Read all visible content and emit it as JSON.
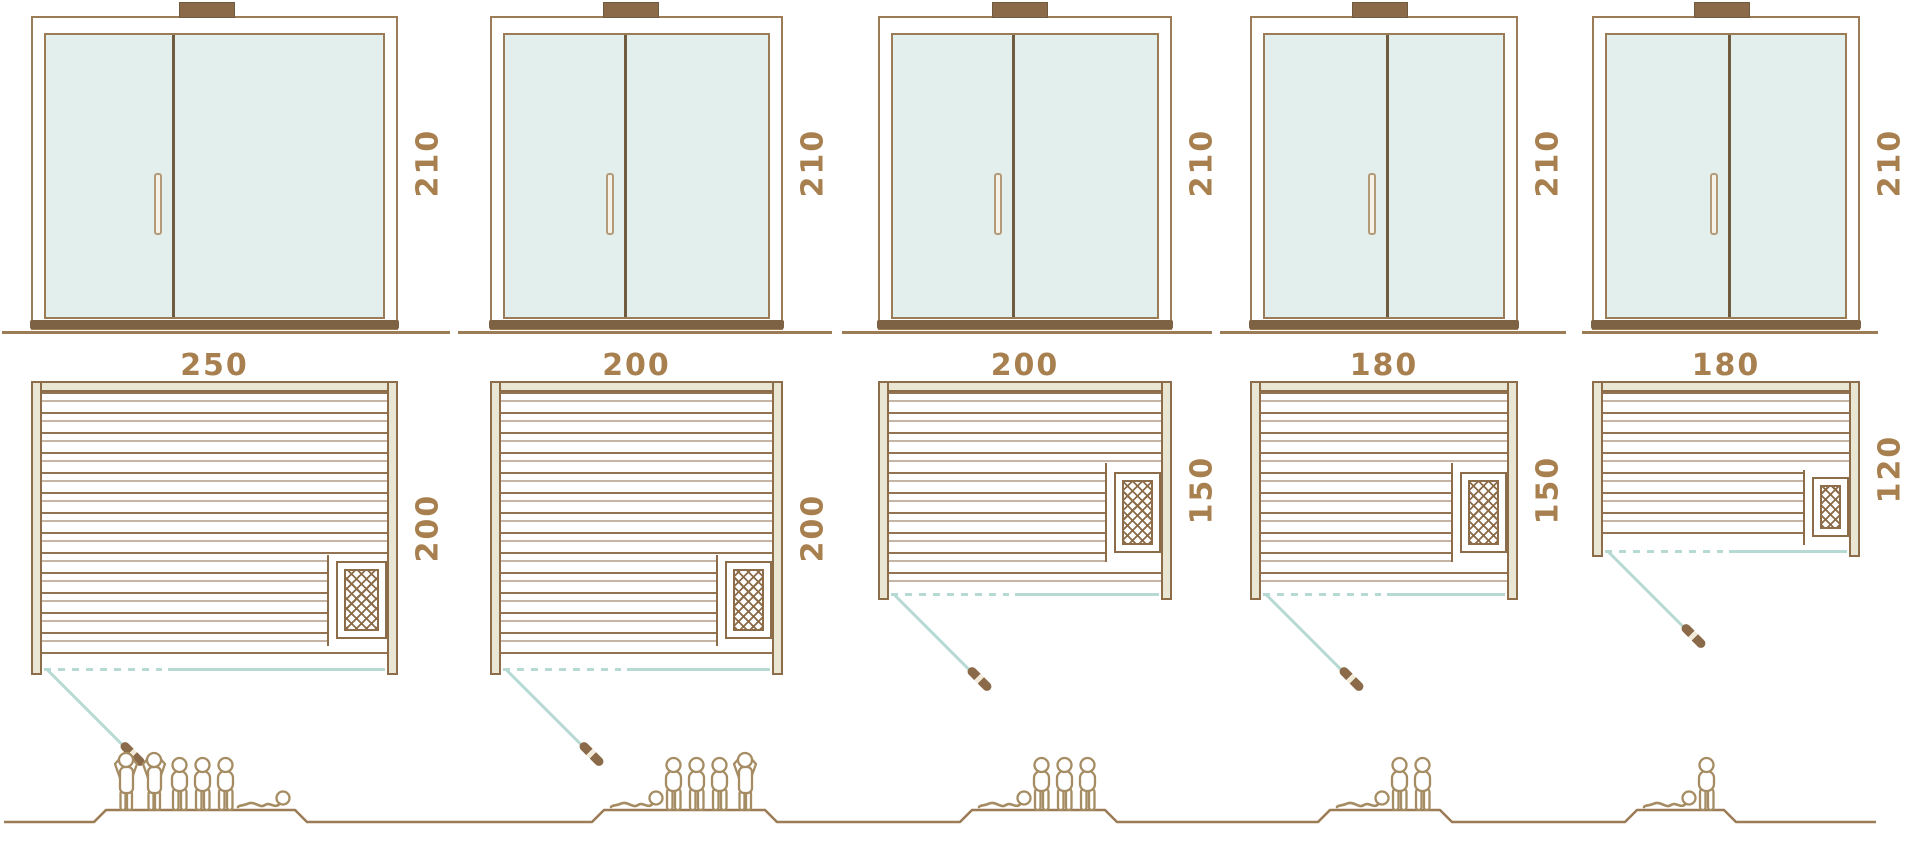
{
  "units": [
    {
      "id": "sauna-1",
      "height_label": "210",
      "width_label": "250",
      "depth_label": "200",
      "capacity": 6,
      "figures": [
        "standing",
        "standing",
        "sitting",
        "sitting",
        "sitting",
        "lying"
      ]
    },
    {
      "id": "sauna-2",
      "height_label": "210",
      "width_label": "200",
      "depth_label": "200",
      "capacity": 5,
      "figures": [
        "lying",
        "sitting",
        "sitting",
        "sitting",
        "standing"
      ]
    },
    {
      "id": "sauna-3",
      "height_label": "210",
      "width_label": "200",
      "depth_label": "150",
      "capacity": 4,
      "figures": [
        "lying",
        "sitting",
        "sitting",
        "sitting"
      ]
    },
    {
      "id": "sauna-4",
      "height_label": "210",
      "width_label": "180",
      "depth_label": "150",
      "capacity": 3,
      "figures": [
        "lying",
        "sitting",
        "sitting"
      ]
    },
    {
      "id": "sauna-5",
      "height_label": "210",
      "width_label": "180",
      "depth_label": "120",
      "capacity": 2,
      "figures": [
        "lying",
        "sitting"
      ]
    }
  ],
  "colors": {
    "line_brown": "#8d6c49",
    "frame_brown": "#9b7c56",
    "dark_brown": "#6f5c40",
    "sill_brown": "#7d6344",
    "beige_fill": "#eae6d4",
    "glass": "#e3efec",
    "teal": "#b7d9d3",
    "label_text": "#a8804f",
    "people_outline": "#a58c62",
    "ground": "#9b7c56"
  }
}
